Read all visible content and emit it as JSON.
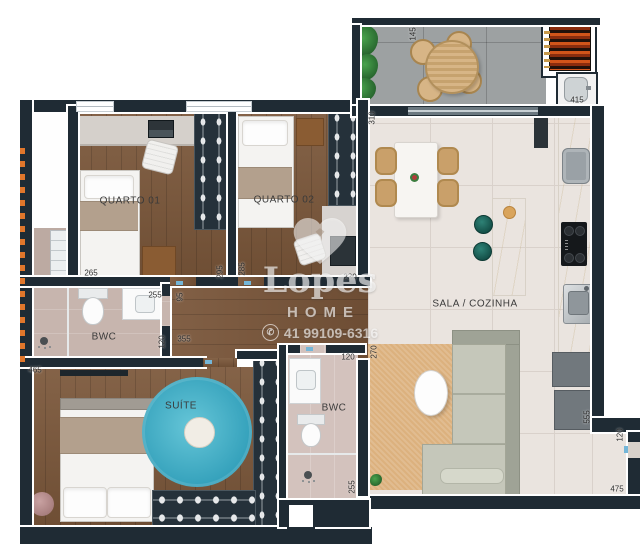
{
  "meta": {
    "type": "apartment-floor-plan"
  },
  "rooms": [
    {
      "id": "quarto-01",
      "label": "QUARTO 01"
    },
    {
      "id": "quarto-02",
      "label": "QUARTO 02"
    },
    {
      "id": "bwc-1",
      "label": "BWC"
    },
    {
      "id": "suite",
      "label": "SUÍTE"
    },
    {
      "id": "bwc-2",
      "label": "BWC"
    },
    {
      "id": "sala-cozinha",
      "label": "SALA / COZINHA"
    }
  ],
  "dimensions": [
    {
      "text": "265"
    },
    {
      "text": "295"
    },
    {
      "text": "285"
    },
    {
      "text": "230"
    },
    {
      "text": "310"
    },
    {
      "text": "145"
    },
    {
      "text": "415"
    },
    {
      "text": "555"
    },
    {
      "text": "120"
    },
    {
      "text": "475"
    },
    {
      "text": "270"
    },
    {
      "text": "95"
    },
    {
      "text": "355"
    },
    {
      "text": "255"
    },
    {
      "text": "120"
    },
    {
      "text": "465"
    },
    {
      "text": "120"
    },
    {
      "text": "255"
    }
  ],
  "watermark": {
    "brand": "Lopes",
    "tagline": "HOME",
    "phone": "41 99109-6316",
    "phone_icon": "whatsapp"
  },
  "colors": {
    "wall": "#1f2b34",
    "wood_floor": "#7b573a",
    "tile_floor": "#eae4df",
    "balcony_floor": "#9da1a2",
    "suite_rug": "#45b5cd",
    "sala_rug": "#dcb17e",
    "sofa": "#c5c7ba",
    "accent_orange": "#e0762b",
    "door_mark": "#74b6d8",
    "grill_coals": "#c24a12"
  }
}
